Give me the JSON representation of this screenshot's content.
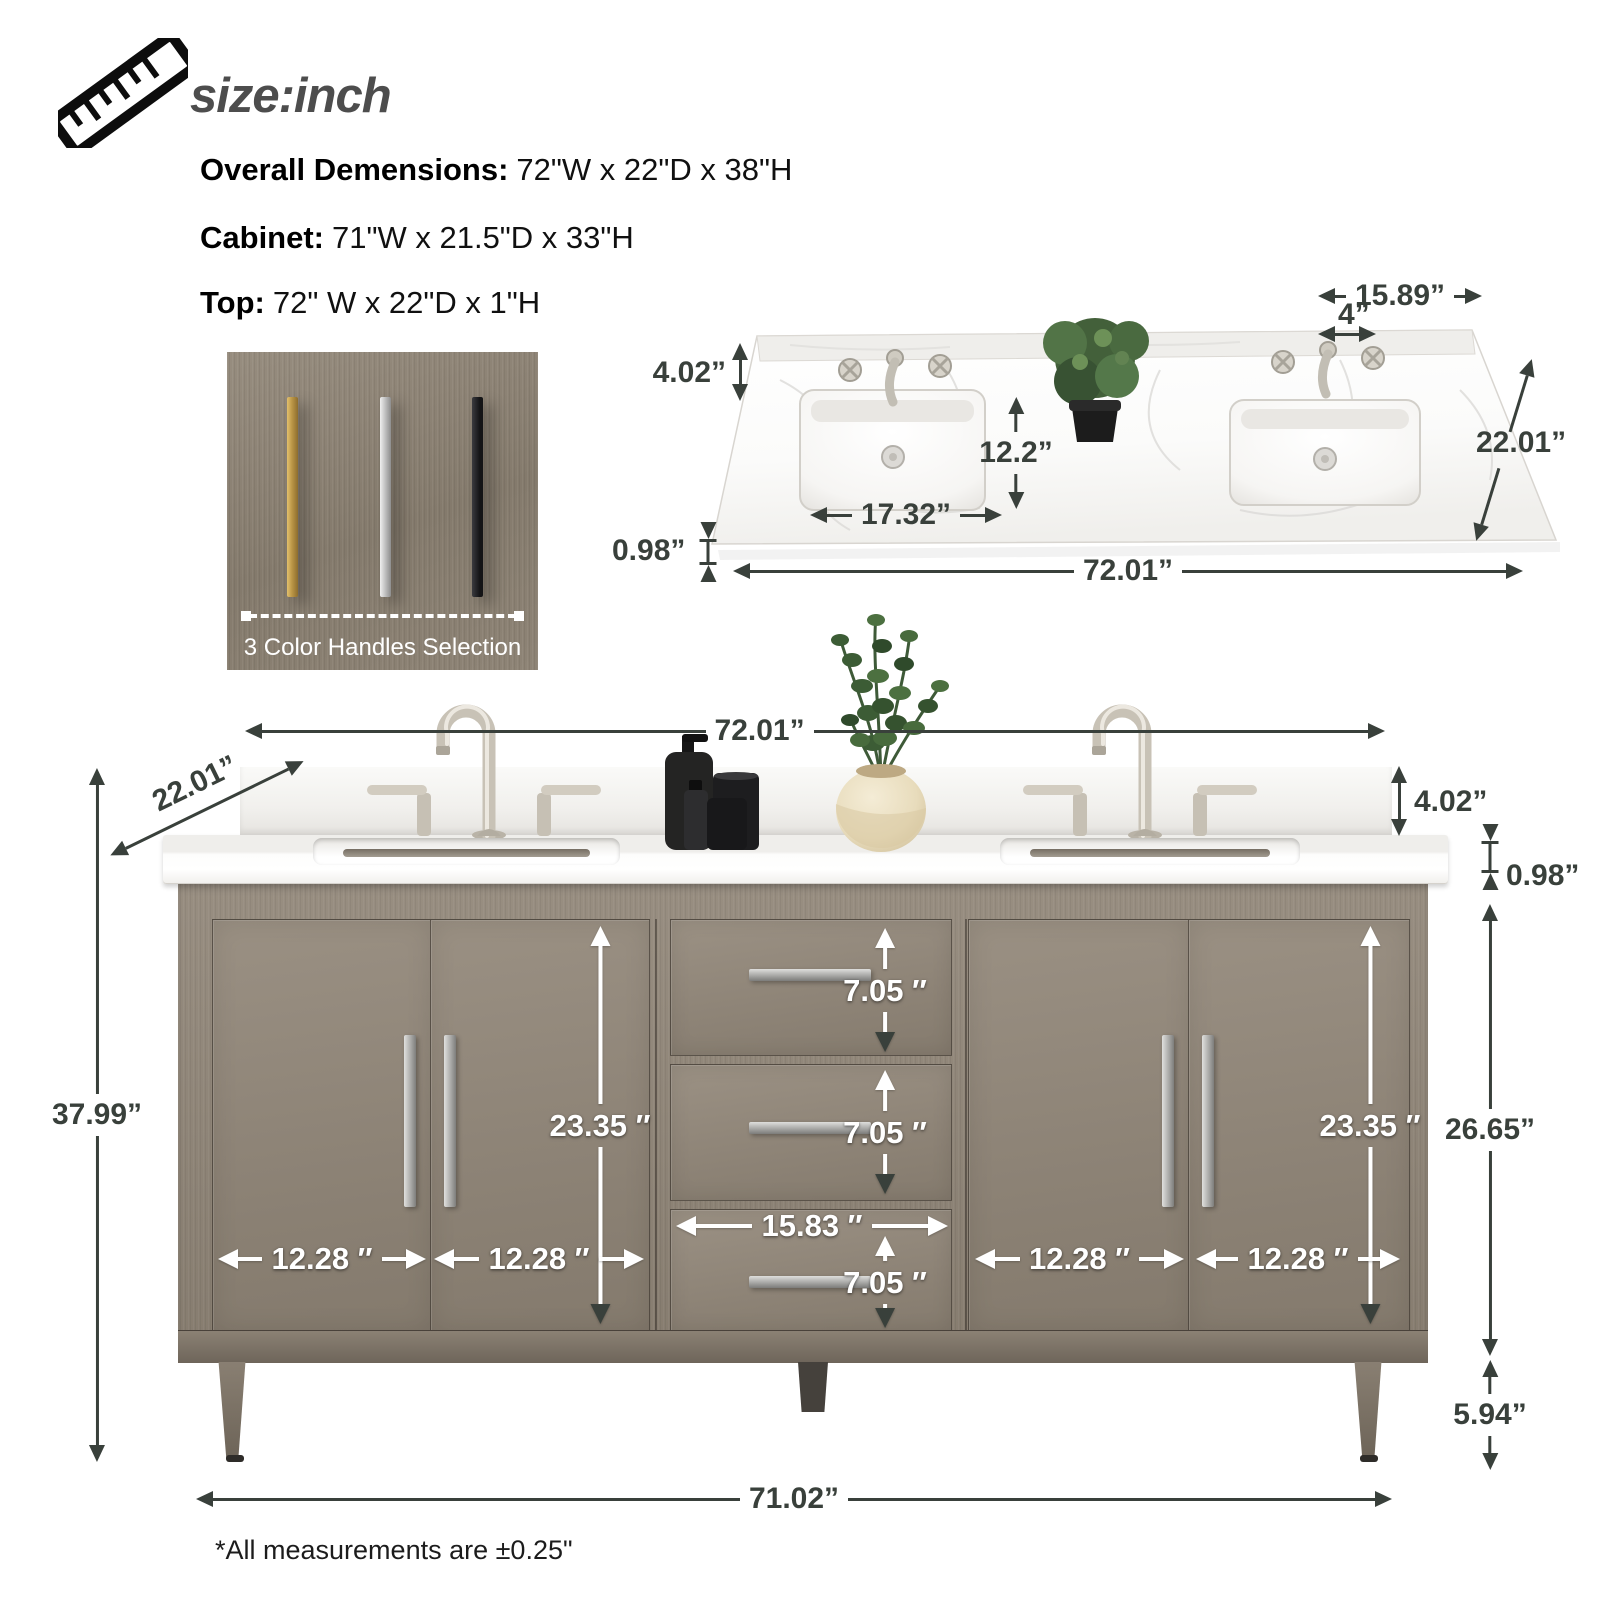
{
  "header": {
    "title": "size:inch"
  },
  "specs": [
    {
      "label": "Overall Demensions:",
      "value": "72\"W x 22\"D x 38\"H"
    },
    {
      "label": "Cabinet:",
      "value": "71\"W x 21.5\"D x 33\"H"
    },
    {
      "label": "Top:",
      "value": "72\" W x 22\"D x 1\"H"
    }
  ],
  "handles": {
    "caption": "3 Color Handles Selection",
    "options": [
      {
        "name": "gold",
        "hex": "#bb9647"
      },
      {
        "name": "silver",
        "hex": "#c3c3c3"
      },
      {
        "name": "black",
        "hex": "#1b1b1d"
      }
    ]
  },
  "countertop": {
    "dims": {
      "sink_offset": "15.89”",
      "faucet_spread": "4”",
      "backsplash": "4.02”",
      "depth": "22.01”",
      "sink_setback": "12.2”",
      "sink_width": "17.32”",
      "thickness": "0.98”",
      "width": "72.01”"
    }
  },
  "vanity": {
    "dims": {
      "width": "72.01”",
      "depth": "22.01”",
      "backsplash": "4.02”",
      "top_thickness": "0.98”",
      "height": "37.99”",
      "door_opening_left": "23.35 ″",
      "door_opening_right": "23.35 ″",
      "drawer_1": "7.05 ″",
      "drawer_2": "7.05 ″",
      "drawer_3": "7.05 ″",
      "drawer_width": "15.83 ″",
      "door_1": "12.28 ″",
      "door_2": "12.28 ″",
      "door_3": "12.28 ″",
      "door_4": "12.28 ″",
      "cabinet_height": "26.65”",
      "leg_height": "5.94”",
      "base_width": "71.02”"
    }
  },
  "footnote": "*All measurements are ±0.25\"",
  "colors": {
    "dim_dark": "#39403b",
    "dim_light": "#ffffff",
    "wood": "#8e8477",
    "marble": "#fdfdfc"
  }
}
